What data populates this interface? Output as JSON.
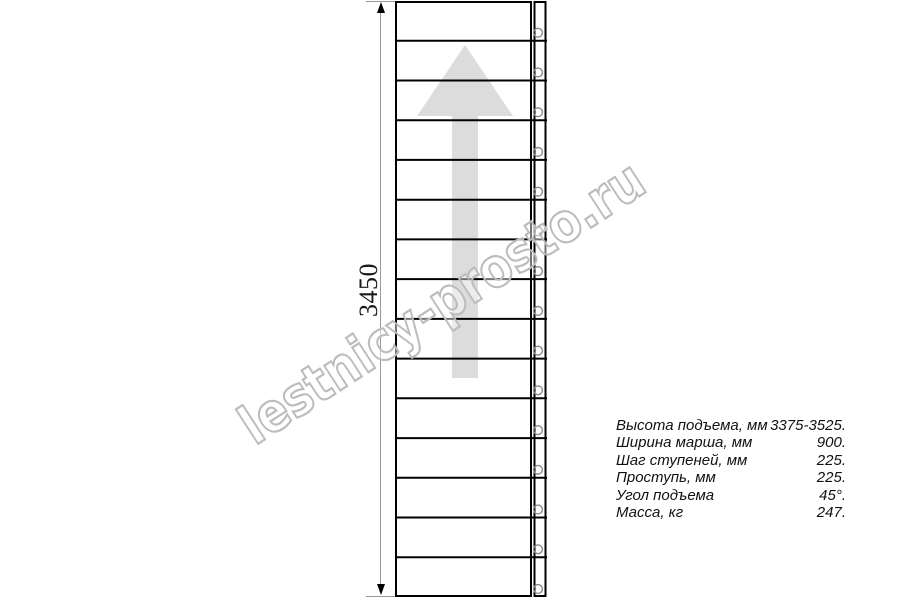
{
  "watermark": {
    "text": "lestnicy-prosto.ru",
    "color": "#bcbcbc"
  },
  "drawing": {
    "tread_rows": 15,
    "fastener_count": 15,
    "line_color": "#000000",
    "arrow_color": "#dcdcdc",
    "fastener_color": "#8a8a8a",
    "dimension": {
      "label": "3450"
    }
  },
  "specs": {
    "rows": [
      {
        "label": "Высота подъема, мм",
        "value": "3375-3525."
      },
      {
        "label": "Ширина марша, мм",
        "value": "900."
      },
      {
        "label": "Шаг ступеней, мм",
        "value": "225."
      },
      {
        "label": "Проступь, мм",
        "value": "225."
      },
      {
        "label": "Угол подъема",
        "value": "45°."
      },
      {
        "label": "Масса, кг",
        "value": "247."
      }
    ]
  }
}
